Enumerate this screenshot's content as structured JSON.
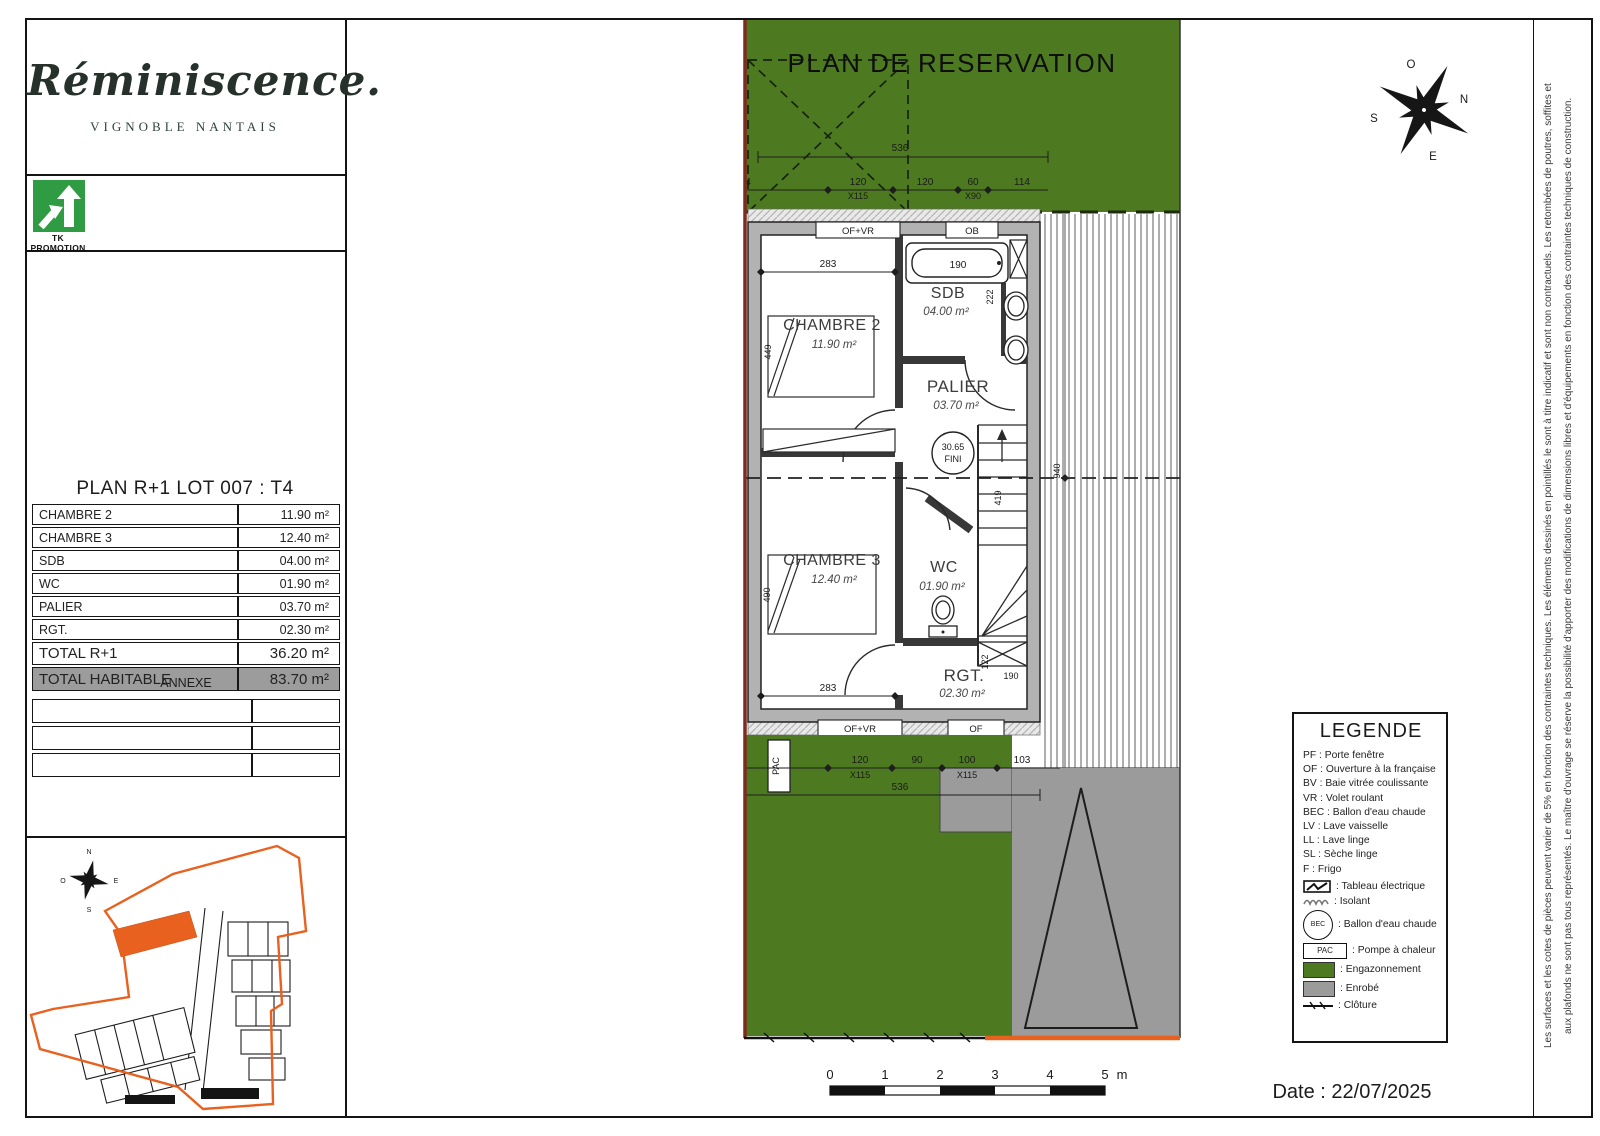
{
  "brand": {
    "name": "Réminiscence.",
    "subtitle": "VIGNOBLE NANTAIS",
    "promoter": "TK PROMOTION"
  },
  "area_table": {
    "title": "PLAN R+1 LOT 007 : T4",
    "rows": [
      {
        "label": "CHAMBRE 2",
        "value": "11.90 m²"
      },
      {
        "label": "CHAMBRE 3",
        "value": "12.40 m²"
      },
      {
        "label": "SDB",
        "value": "04.00 m²"
      },
      {
        "label": "WC",
        "value": "01.90 m²"
      },
      {
        "label": "PALIER",
        "value": "03.70 m²"
      },
      {
        "label": "RGT.",
        "value": "02.30 m²"
      }
    ],
    "total_r1": {
      "label": "TOTAL R+1",
      "value": "36.20 m²"
    },
    "total_hab": {
      "label": "TOTAL HABITABLE",
      "value": "83.70 m²"
    },
    "annexe_label": "ANNEXE"
  },
  "plan": {
    "title": "PLAN DE RESERVATION",
    "rooms": [
      {
        "name": "CHAMBRE 2",
        "area": "11.90 m²"
      },
      {
        "name": "SDB",
        "area": "04.00 m²"
      },
      {
        "name": "PALIER",
        "area": "03.70 m²"
      },
      {
        "name": "CHAMBRE 3",
        "area": "12.40 m²"
      },
      {
        "name": "WC",
        "area": "01.90 m²"
      },
      {
        "name": "RGT.",
        "area": "02.30 m²"
      }
    ],
    "level_marker": {
      "value": "30.65",
      "suffix": "FINI"
    },
    "openings": {
      "top_left": "OF+VR",
      "top_right": "OB",
      "bottom_left": "OF+VR",
      "bottom_right": "OF",
      "pac": "PAC"
    },
    "dims_top": {
      "overall": "536",
      "left_cut": "4",
      "w1": "120",
      "w1b": "X115",
      "w2": "120",
      "w3": "60",
      "w3b": "X90",
      "w4": "114"
    },
    "dims_bottom": {
      "overall": "536",
      "w1": "120",
      "w1b": "X115",
      "w2": "90",
      "w3": "100",
      "w3b": "X115",
      "w4": "103"
    },
    "dims_inner": {
      "chambre2_w": "283",
      "chambre2_h": "449",
      "chambre3_w": "283",
      "chambre3_h": "490",
      "bath": "190",
      "sdb_h": "222",
      "stairs": "419",
      "right": "940",
      "rgt_h": "122",
      "rgt_w": "190"
    }
  },
  "legend": {
    "title": "LEGENDE",
    "abbr": [
      "PF : Porte fenêtre",
      "OF : Ouverture à la française",
      "BV : Baie vitrée coulissante",
      "VR : Volet roulant",
      "BEC : Ballon d'eau chaude",
      "LV : Lave vaisselle",
      "LL : Lave linge",
      "SL : Sèche linge",
      "F : Frigo"
    ],
    "symbols": [
      {
        "label": ": Tableau électrique"
      },
      {
        "label": ": Isolant"
      },
      {
        "label": ": Ballon d'eau chaude"
      },
      {
        "label": ": Pompe à chaleur"
      },
      {
        "label": ": Engazonnement"
      },
      {
        "label": ": Enrobé"
      },
      {
        "label": ": Clôture"
      }
    ],
    "bec_text": "BEC",
    "pac_text": "PAC"
  },
  "compass": {
    "n": "N",
    "s": "S",
    "e": "E",
    "o": "O"
  },
  "scalebar": {
    "ticks": [
      "0",
      "1",
      "2",
      "3",
      "4",
      "5"
    ],
    "unit": "m"
  },
  "footer": {
    "date": "Date : 22/07/2025"
  },
  "disclaimer": {
    "line1": "Les surfaces et les cotes de pièces peuvent varier de 5% en fonction des contraintes techniques. Les éléments dessinés en pointillés le sont à titre indicatif et sont non contractuels. Les retombées de poutres, soffites et",
    "line2": "aux plafonds ne sont pas tous représentés. Le maître d'ouvrage se réserve la possibilité d'apporter des modifications de dimensions libres et d'équipements en fonction des contraintes techniques de construction."
  },
  "colors": {
    "grass": "#4d7a20",
    "asphalt": "#9b9b9b",
    "boundary_orange": "#e8611f",
    "boundary_red": "#7c2d1e",
    "tk_green": "#2f9c43",
    "total_row_bg": "#9c9c9c"
  }
}
